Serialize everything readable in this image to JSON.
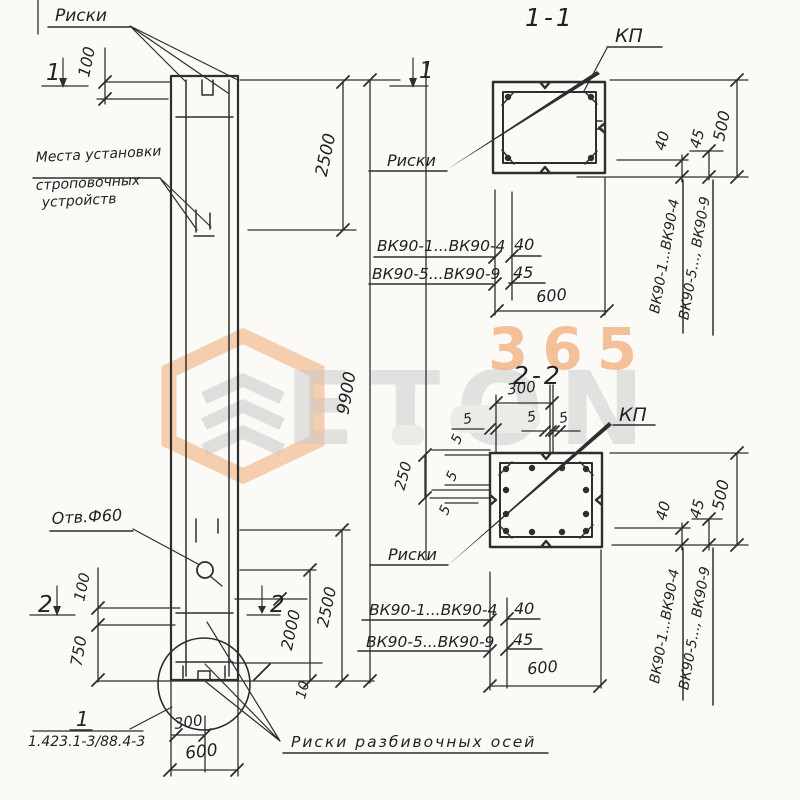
{
  "drawing": {
    "titles": {
      "s1": "1-1",
      "s2": "2-2"
    },
    "labels": {
      "riski": "Риски",
      "kp": "КП",
      "mesta1": "Места установки",
      "mesta2": "строповочных",
      "mesta3": "устройств",
      "otv": "Отв.Ф60",
      "riski_axes": "Риски разбивочных осей",
      "detail_num": "1",
      "detail_series": "1.423.1-3/88.4-3"
    },
    "markers": {
      "m1": "1",
      "m2": "2"
    },
    "dims": {
      "d100": "100",
      "d750": "750",
      "d2500": "2500",
      "d9900": "9900",
      "d2000": "2000",
      "d10": "10",
      "d300": "300",
      "d600": "600",
      "d500": "500",
      "d40": "40",
      "d45": "45",
      "d5": "5",
      "d250": "250"
    },
    "table": {
      "rows": [
        {
          "range": "ВК90-1...ВК90-4",
          "cover": "40"
        },
        {
          "range": "ВК90-5...ВК90-9",
          "cover": "45"
        }
      ],
      "width": "600"
    },
    "side_labels": {
      "a": "ВК90-1...ВК90-4",
      "b": "ВК90-5..., ВК90-9"
    }
  },
  "watermark": {
    "word": "ETON",
    "number": "365"
  }
}
